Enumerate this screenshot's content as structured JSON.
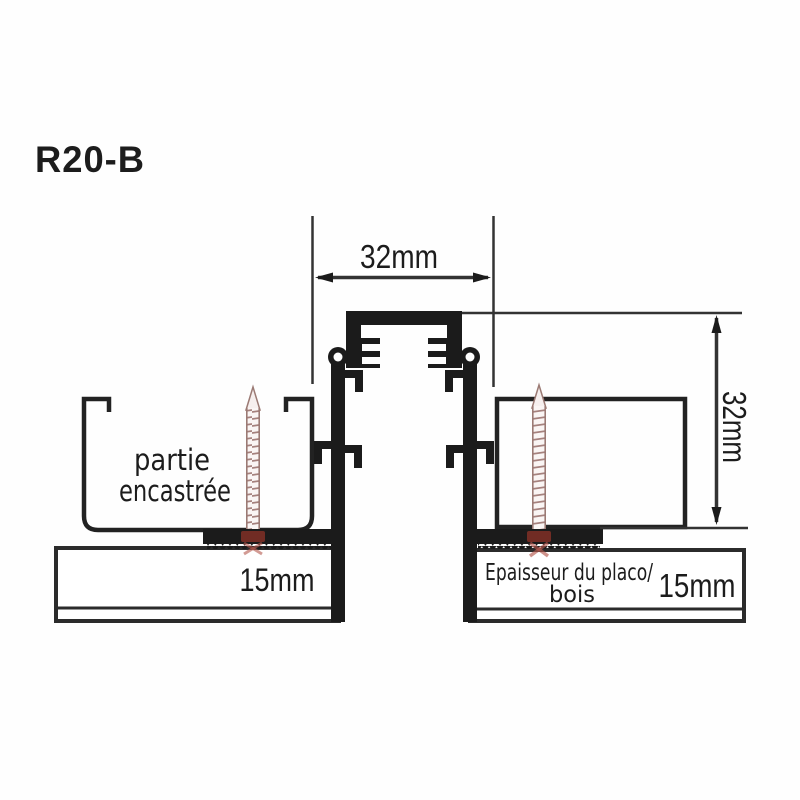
{
  "title": "R20-B",
  "dimensions": {
    "opening_width": "32mm",
    "profile_height": "32mm",
    "board_left_thickness": "15mm",
    "board_right_thickness": "15mm"
  },
  "labels": {
    "recessed_line1": "partie",
    "recessed_line2": "encastrée",
    "board_line1": "Epaisseur du placo/",
    "board_line2": "bois"
  },
  "colors": {
    "line": "#1b1b1b",
    "outline": "#2b2b2b",
    "screw": "#a5817d",
    "screw_head": "#7b2f26",
    "background": "#fefefe"
  }
}
